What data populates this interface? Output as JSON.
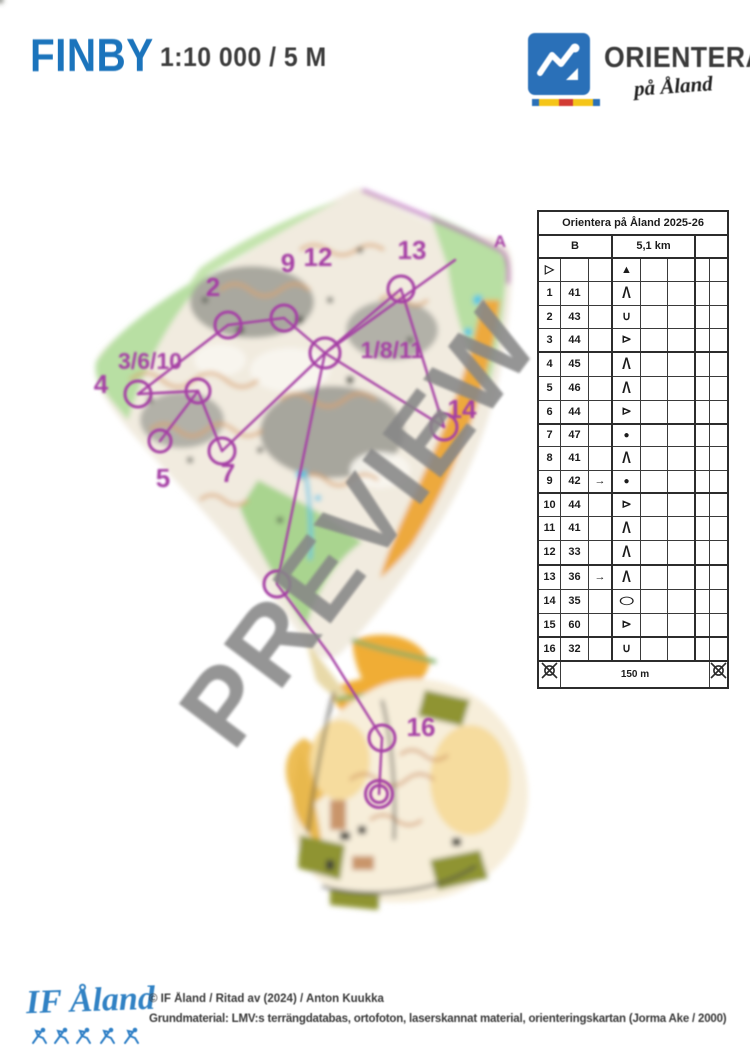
{
  "header": {
    "title": "FINBY",
    "scale": "1:10 000 / 5 M",
    "logo_name": "ORIENTERA",
    "logo_tagline": "på Åland"
  },
  "watermark": "PREVIEW",
  "control_card": {
    "title": "Orientera på Åland 2025-26",
    "course": "B",
    "length": "5,1 km",
    "climb": "",
    "start": {
      "start_glyph": "▷",
      "feature_glyph": "▲",
      "feature": "boulder"
    },
    "rows": [
      {
        "n": "1",
        "code": "41",
        "c": "",
        "d": "Λ",
        "feature": "cliff"
      },
      {
        "n": "2",
        "code": "43",
        "c": "",
        "d": "∪",
        "feature": "re-entrant"
      },
      {
        "n": "3",
        "code": "44",
        "c": "",
        "d": "⊳",
        "feature": "spur"
      },
      {
        "n": "4",
        "code": "45",
        "c": "",
        "d": "Λ",
        "feature": "cliff"
      },
      {
        "n": "5",
        "code": "46",
        "c": "",
        "d": "Λ",
        "feature": "cliff"
      },
      {
        "n": "6",
        "code": "44",
        "c": "",
        "d": "⊳",
        "feature": "spur"
      },
      {
        "n": "7",
        "code": "47",
        "c": "",
        "d": "●",
        "feature": "knoll"
      },
      {
        "n": "8",
        "code": "41",
        "c": "",
        "d": "Λ",
        "feature": "cliff"
      },
      {
        "n": "9",
        "code": "42",
        "c": "→",
        "d": "●",
        "feature": "knoll"
      },
      {
        "n": "10",
        "code": "44",
        "c": "",
        "d": "⊳",
        "feature": "spur"
      },
      {
        "n": "11",
        "code": "41",
        "c": "",
        "d": "Λ",
        "feature": "cliff"
      },
      {
        "n": "12",
        "code": "33",
        "c": "",
        "d": "Λ",
        "feature": "cliff"
      },
      {
        "n": "13",
        "code": "36",
        "c": "→",
        "d": "Λ",
        "feature": "cliff"
      },
      {
        "n": "14",
        "code": "35",
        "c": "",
        "d": "◯",
        "feature": "depression"
      },
      {
        "n": "15",
        "code": "60",
        "c": "",
        "d": "⊳",
        "feature": "spur"
      },
      {
        "n": "16",
        "code": "32",
        "c": "",
        "d": "∪",
        "feature": "re-entrant"
      }
    ],
    "finish_distance": "150 m"
  },
  "map": {
    "corner_label": "A",
    "course_color": "#a53fa5",
    "labels": [
      {
        "t": "2",
        "x": 213,
        "y": 296,
        "s": 26
      },
      {
        "t": "9",
        "x": 288,
        "y": 272,
        "s": 26
      },
      {
        "t": "12",
        "x": 318,
        "y": 266,
        "s": 26
      },
      {
        "t": "13",
        "x": 412,
        "y": 259,
        "s": 26
      },
      {
        "t": "A",
        "x": 500,
        "y": 247,
        "s": 17
      },
      {
        "t": "1/8/11",
        "x": 392,
        "y": 358,
        "s": 23
      },
      {
        "t": "3/6/10",
        "x": 150,
        "y": 369,
        "s": 23
      },
      {
        "t": "4",
        "x": 101,
        "y": 393,
        "s": 26
      },
      {
        "t": "5",
        "x": 163,
        "y": 487,
        "s": 26
      },
      {
        "t": "7",
        "x": 228,
        "y": 482,
        "s": 26
      },
      {
        "t": "14",
        "x": 462,
        "y": 418,
        "s": 26
      },
      {
        "t": "16",
        "x": 421,
        "y": 736,
        "s": 26
      }
    ],
    "circles": [
      [
        228,
        325,
        13
      ],
      [
        284,
        318,
        13
      ],
      [
        325,
        353,
        15
      ],
      [
        401,
        289,
        13
      ],
      [
        138,
        394,
        13
      ],
      [
        198,
        391,
        12
      ],
      [
        222,
        451,
        13
      ],
      [
        160,
        441,
        11
      ],
      [
        444,
        427,
        13
      ],
      [
        277,
        584,
        13
      ],
      [
        382,
        738,
        13
      ]
    ],
    "finish": {
      "x": 379,
      "y": 794,
      "r_inner": 8.5,
      "r_outer": 13.5
    },
    "legs": [
      [
        228,
        325,
        284,
        318
      ],
      [
        284,
        318,
        325,
        353
      ],
      [
        325,
        353,
        401,
        289
      ],
      [
        401,
        289,
        444,
        427
      ],
      [
        444,
        427,
        325,
        353
      ],
      [
        325,
        353,
        222,
        451
      ],
      [
        222,
        451,
        198,
        391
      ],
      [
        198,
        391,
        138,
        394
      ],
      [
        138,
        394,
        228,
        325
      ],
      [
        160,
        441,
        198,
        391
      ],
      [
        325,
        353,
        455,
        260
      ],
      [
        277,
        584,
        325,
        353
      ],
      [
        277,
        584,
        330,
        655
      ],
      [
        330,
        655,
        382,
        738
      ],
      [
        382,
        738,
        379,
        794
      ]
    ]
  },
  "footer": {
    "logo_text": "IF Åland",
    "line1": "© IF Åland / Ritad av (2024) / Anton Kuukka",
    "line2": "Grundmaterial: LMV:s terrängdatabas, ortofoton, laserskannat material, orienteringskartan (Jorma Ake / 2000)"
  }
}
